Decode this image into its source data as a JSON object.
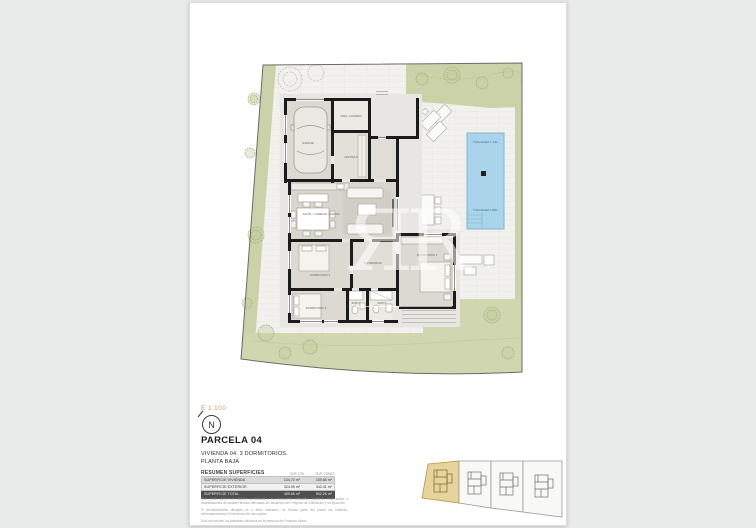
{
  "document": {
    "scale": "E 1:100",
    "north": "N",
    "title": "PARCELA 04",
    "subtitle1": "VIVIENDA 04. 3 DORMITORIOS.",
    "subtitle2": "PLANTA BAJA",
    "table": {
      "title": "RESUMEN SUPERFICIES",
      "col_util": "SUP. ÚTIL",
      "col_const": "SUP. CONST.",
      "rows": [
        {
          "label": "SUPERFICIE VIVIENDA",
          "util": "134.70 m²",
          "constr": "159.85 m²"
        },
        {
          "label": "SUPERFICIE EXTERIOR",
          "util": "324.95 m²",
          "constr": "342.41 m²"
        },
        {
          "label": "SUPERFICIE TOTAL",
          "util": "459.65 m²",
          "constr": "502.26 m²"
        }
      ]
    },
    "disclaimer": {
      "p1": "Este plano carece de carácter contractual y es meramente orientativo, pudiendo estar sujeto a modificaciones de carácter técnico derivadas del desarrollo del Proyecto de Edificación y su ejecución.",
      "p2": "El amueblamiento dibujado es a título indicativo; no forman parte del precio los muebles, electrodomésticos ni elementos de decoración.",
      "p3": "Solo se incluyen los acabados descritos en la memoria del Proyecto citado."
    }
  },
  "plan": {
    "labels": {
      "garage": "GARAJE",
      "laundry": "ASEO - LAVADERO",
      "entry_hall": "VESTÍBULO",
      "living": "SALÓN - COMEDOR - COCINA",
      "bedroom1": "DORMITORIO 1",
      "bedroom2": "DORMITORIO 2",
      "bedroom3": "DORMITORIO 3",
      "bath1": "BAÑO 1",
      "bath2": "BAÑO 2",
      "hall": "DISTRIBUIDOR",
      "pool_depth_shallow": "Profundidad 1.40m",
      "pool_depth_deep": "Profundidad 1.80m"
    }
  },
  "watermark": {
    "monogram": "ЯR"
  },
  "colors": {
    "accent_gold": "#c3a05c",
    "green": "#cbd2aa",
    "pool": "#a9d4ea",
    "wall": "#1b1b1b",
    "table_dark_row": "#4f4f4f"
  }
}
